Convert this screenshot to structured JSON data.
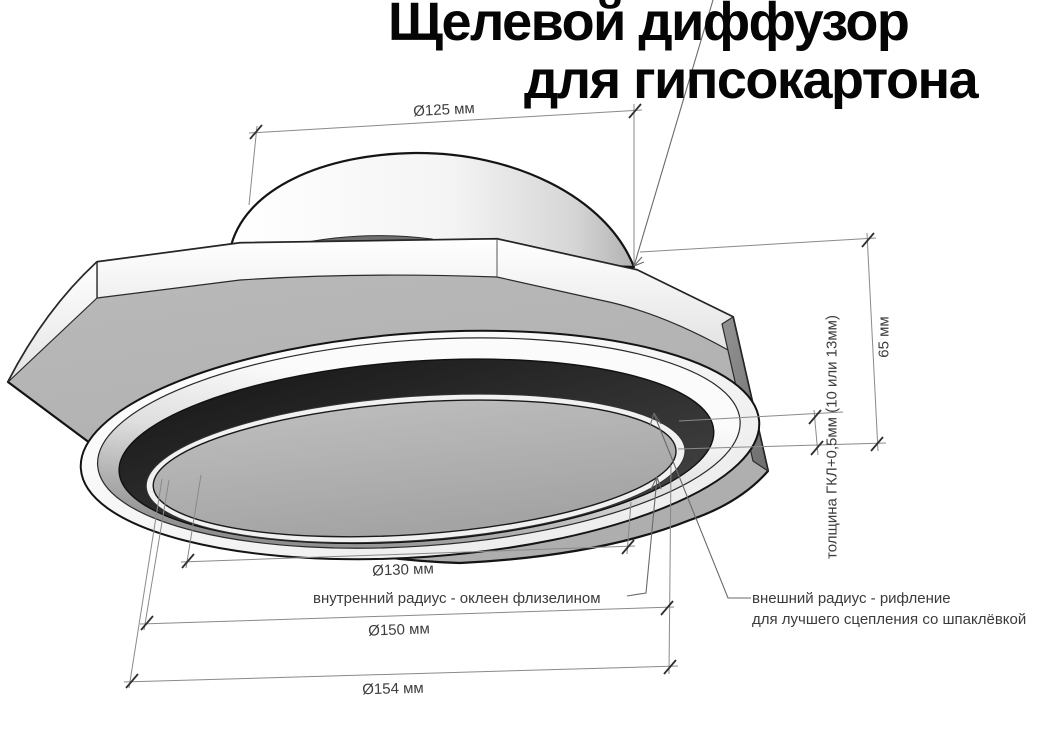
{
  "title": {
    "line1": "Щелевой диффузор",
    "line2": "для гипсокартона"
  },
  "dimensions": {
    "collar_diameter": "Ø125 мм",
    "height": "65 мм",
    "drywall_thickness": "толщина ГКЛ+0,5мм (10 или 13мм)",
    "inner_diameter": "Ø130 мм",
    "outer_diameter": "Ø150 мм",
    "overall_diameter": "Ø154 мм"
  },
  "annotations": {
    "inner_radius": "внутренний радиус - оклеен флизелином",
    "outer_radius_line1": "внешний радиус - рифление",
    "outer_radius_line2": "для лучшего сцепления со шпаклёвкой"
  },
  "colors": {
    "background": "#ffffff",
    "title_text": "#050505",
    "outline": "#1a1a1a",
    "dimension_line": "#8a8a8a",
    "dimension_tick": "#2f2f2f",
    "dimension_text": "#3d3d3d",
    "plate_face": "#b6b6b6",
    "side_face_dark": "#7a7a7a",
    "slot_dark": "#242424",
    "disc_face": "#b0b0b0",
    "highlight_white": "#fcfcfc"
  }
}
